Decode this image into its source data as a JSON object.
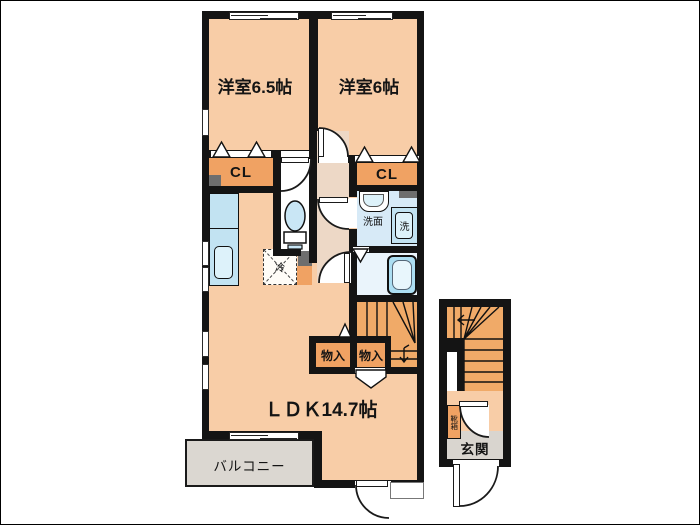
{
  "title": "2F apartment floor plan",
  "labels": {
    "bedroom1": "洋室6.5帖",
    "bedroom2": "洋室6帖",
    "closet1": "CL",
    "closet2": "CL",
    "washroom": "洗面",
    "washer": "洗",
    "fridge": "冷",
    "storage1": "物入",
    "storage2": "物入",
    "ldk": "ＬＤＫ14.7帖",
    "balcony": "バルコニー",
    "entrance": "玄関",
    "shoe_cabinet": "靴箱"
  },
  "colors": {
    "wall": "#141414",
    "room": "#F8CDA7",
    "hall": "#EDD8C6",
    "closet_orange": "#F0A263",
    "stairs_orange": "#F0AA68",
    "entry_gray": "#D9D5CF",
    "balcony_gray": "#DBD7D1",
    "fixture_blue": "#C2E3F2",
    "fixture_blue_light": "#DDF2FA",
    "washroom_floor": "#D7EAF7",
    "bath_floor": "#EAF4FB",
    "tub_blue": "#ACDEF2",
    "toilet_blue": "#C9E6F5",
    "accent_gray": "#6E6E6E"
  }
}
